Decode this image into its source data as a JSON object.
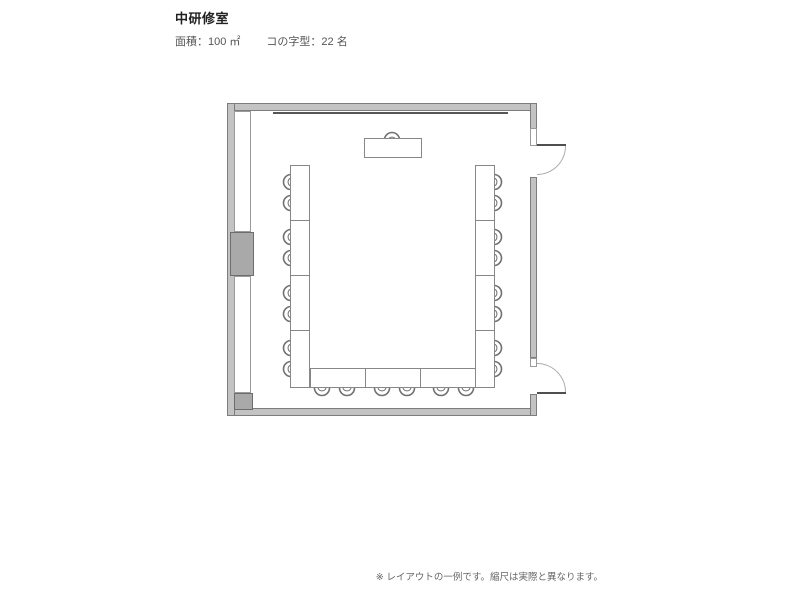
{
  "header": {
    "title": "中研修室",
    "area_label": "面積：100 ㎡",
    "layout_label": "コの字型：22 名"
  },
  "footer": {
    "note": "※ レイアウトの一例です。縮尺は実際と異なります。"
  },
  "colors": {
    "background": "#ffffff",
    "wall_fill": "#c3c3c3",
    "wall_outline": "#7d7d7d",
    "pillar_fill": "#a9a9a9",
    "furniture_outline": "#878787",
    "text_title": "#222222",
    "text_body": "#555555",
    "text_note": "#666666"
  },
  "floorplan": {
    "layout_type": "u-shape",
    "capacity": 22,
    "seats": {
      "left": 8,
      "right": 8,
      "bottom": 6,
      "presenter": 1
    },
    "rects": [
      {
        "name": "wall-top",
        "cls": "wall",
        "x": 227,
        "y": 103,
        "w": 310,
        "h": 8
      },
      {
        "name": "wall-bottom",
        "cls": "wall",
        "x": 227,
        "y": 408,
        "w": 310,
        "h": 8
      },
      {
        "name": "wall-left",
        "cls": "wall",
        "x": 227,
        "y": 103,
        "w": 8,
        "h": 313
      },
      {
        "name": "wall-right-upper",
        "cls": "wall",
        "x": 530,
        "y": 103,
        "w": 7,
        "h": 26
      },
      {
        "name": "wall-right-middle",
        "cls": "wall",
        "x": 530,
        "y": 177,
        "w": 7,
        "h": 181
      },
      {
        "name": "wall-right-lower",
        "cls": "wall",
        "x": 530,
        "y": 394,
        "w": 7,
        "h": 22
      },
      {
        "name": "door-frame-top",
        "cls": "frame",
        "x": 530,
        "y": 128,
        "w": 7,
        "h": 18
      },
      {
        "name": "door-frame-bottom",
        "cls": "frame",
        "x": 530,
        "y": 358,
        "w": 7,
        "h": 9
      },
      {
        "name": "window-strip-upper",
        "cls": "frame",
        "x": 234,
        "y": 111,
        "w": 17,
        "h": 121
      },
      {
        "name": "window-strip-lower",
        "cls": "frame",
        "x": 234,
        "y": 276,
        "w": 17,
        "h": 117
      },
      {
        "name": "wall-pillar",
        "cls": "block",
        "x": 230,
        "y": 232,
        "w": 24,
        "h": 44
      },
      {
        "name": "wall-corner-block",
        "cls": "block",
        "x": 234,
        "y": 393,
        "w": 19,
        "h": 17
      },
      {
        "name": "front-board-line",
        "cls": "line",
        "x": 273,
        "y": 112,
        "w": 235,
        "h": 2
      },
      {
        "name": "door-leaf-top",
        "cls": "leaf",
        "x": 537,
        "y": 144,
        "w": 29,
        "h": 2
      },
      {
        "name": "door-leaf-bottom",
        "cls": "leaf",
        "x": 537,
        "y": 392,
        "w": 29,
        "h": 2
      },
      {
        "name": "door-swing-top",
        "cls": "arc-se",
        "x": 537,
        "y": 146,
        "w": 29,
        "h": 29
      },
      {
        "name": "door-swing-bottom",
        "cls": "arc-ne",
        "x": 537,
        "y": 363,
        "w": 29,
        "h": 29
      }
    ],
    "tables": [
      {
        "name": "presenter-table",
        "x": 364,
        "y": 138,
        "w": 58,
        "h": 20
      },
      {
        "name": "table-left-1",
        "x": 290,
        "y": 165,
        "w": 20,
        "h": 56
      },
      {
        "name": "table-left-2",
        "x": 290,
        "y": 220,
        "w": 20,
        "h": 56
      },
      {
        "name": "table-left-3",
        "x": 290,
        "y": 275,
        "w": 20,
        "h": 56
      },
      {
        "name": "table-left-4",
        "x": 290,
        "y": 330,
        "w": 20,
        "h": 58
      },
      {
        "name": "table-right-1",
        "x": 475,
        "y": 165,
        "w": 20,
        "h": 56
      },
      {
        "name": "table-right-2",
        "x": 475,
        "y": 220,
        "w": 20,
        "h": 56
      },
      {
        "name": "table-right-3",
        "x": 475,
        "y": 275,
        "w": 20,
        "h": 56
      },
      {
        "name": "table-right-4",
        "x": 475,
        "y": 330,
        "w": 20,
        "h": 58
      },
      {
        "name": "table-bottom-1",
        "x": 310,
        "y": 368,
        "w": 56,
        "h": 20
      },
      {
        "name": "table-bottom-2",
        "x": 365,
        "y": 368,
        "w": 56,
        "h": 20
      },
      {
        "name": "table-bottom-3",
        "x": 420,
        "y": 368,
        "w": 56,
        "h": 20
      }
    ],
    "chairs": [
      {
        "o": "up",
        "x": 382,
        "y": 129
      },
      {
        "o": "left",
        "x": 280,
        "y": 172
      },
      {
        "o": "left",
        "x": 280,
        "y": 193
      },
      {
        "o": "left",
        "x": 280,
        "y": 227
      },
      {
        "o": "left",
        "x": 280,
        "y": 248
      },
      {
        "o": "left",
        "x": 280,
        "y": 283
      },
      {
        "o": "left",
        "x": 280,
        "y": 304
      },
      {
        "o": "left",
        "x": 280,
        "y": 338
      },
      {
        "o": "left",
        "x": 280,
        "y": 359
      },
      {
        "o": "right",
        "x": 493,
        "y": 172
      },
      {
        "o": "right",
        "x": 493,
        "y": 193
      },
      {
        "o": "right",
        "x": 493,
        "y": 227
      },
      {
        "o": "right",
        "x": 493,
        "y": 248
      },
      {
        "o": "right",
        "x": 493,
        "y": 283
      },
      {
        "o": "right",
        "x": 493,
        "y": 304
      },
      {
        "o": "right",
        "x": 493,
        "y": 338
      },
      {
        "o": "right",
        "x": 493,
        "y": 359
      },
      {
        "o": "down",
        "x": 312,
        "y": 387
      },
      {
        "o": "down",
        "x": 337,
        "y": 387
      },
      {
        "o": "down",
        "x": 372,
        "y": 387
      },
      {
        "o": "down",
        "x": 397,
        "y": 387
      },
      {
        "o": "down",
        "x": 431,
        "y": 387
      },
      {
        "o": "down",
        "x": 456,
        "y": 387
      }
    ]
  }
}
